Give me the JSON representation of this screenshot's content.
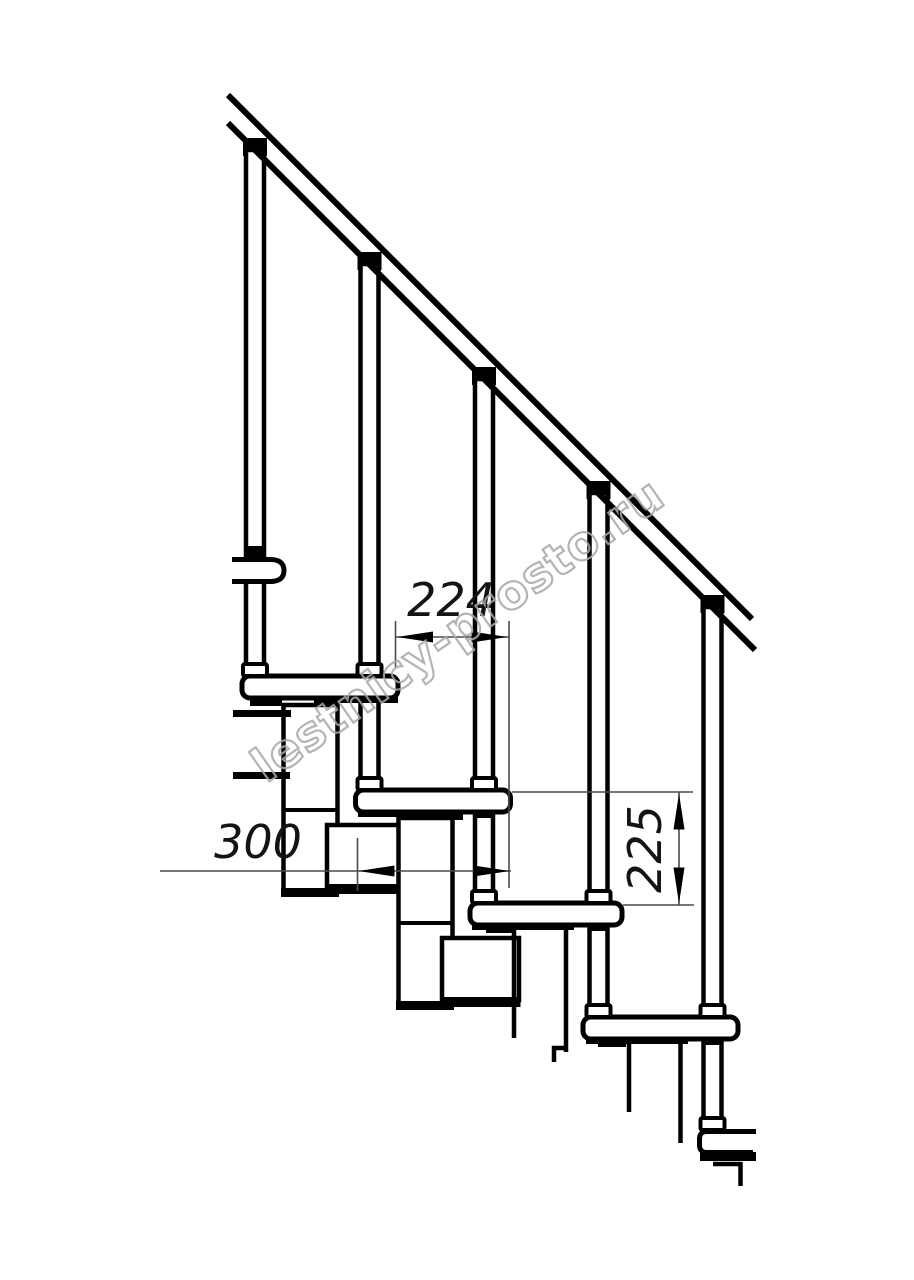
{
  "dimensions": {
    "step_run": {
      "label": "224"
    },
    "tread_depth": {
      "label": "300"
    },
    "step_rise": {
      "label": "225"
    }
  },
  "watermark": {
    "text": "lestnicy-prosto.ru"
  },
  "colors": {
    "line": "#000000",
    "dimension_line": "#4a4a4a",
    "watermark": "#a8a8a8",
    "background": "#ffffff"
  }
}
